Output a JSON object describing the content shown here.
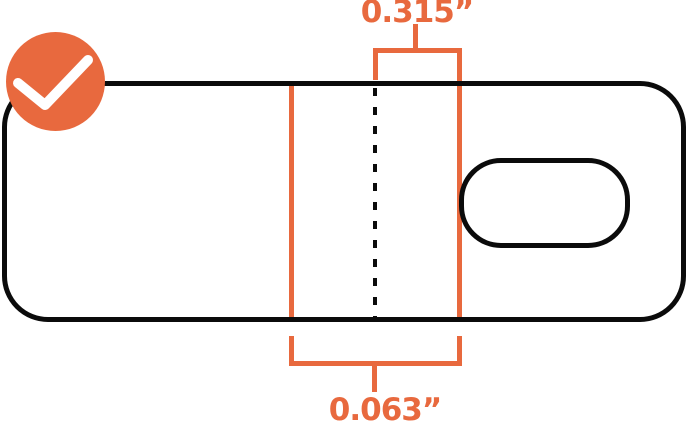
{
  "diagram": {
    "type": "dimension-callout-diagram",
    "subject": "rounded tag with slot hole, centerline and dimension brackets",
    "status_icon": "check-icon",
    "colors": {
      "accent_orange": "#E8693E",
      "outline_black": "#0B0B0B",
      "background": "#FFFFFF"
    },
    "dimensions": {
      "top": {
        "label": "0.315”"
      },
      "bottom": {
        "label": "0.063”"
      }
    }
  }
}
